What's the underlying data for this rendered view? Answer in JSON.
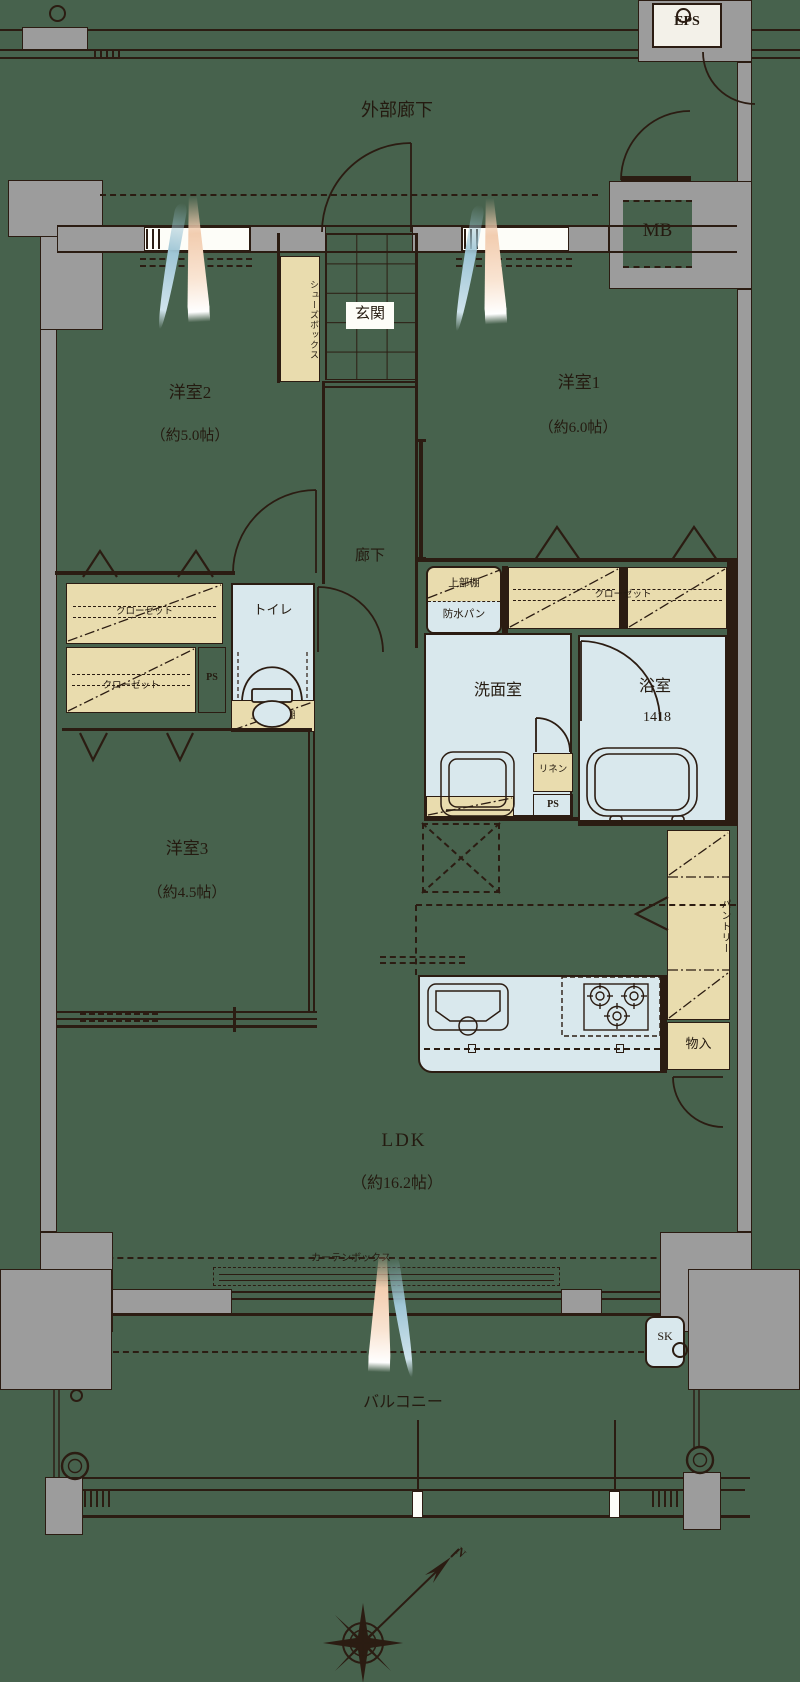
{
  "colors": {
    "background_green": "#47624d",
    "wall_gray": "#9c9c9c",
    "storage_beige": "#e9dcae",
    "water_blue": "#d9e8ed",
    "linework": "#2b1c12",
    "brush_pink": "#f2cdb0",
    "brush_blue": "#9fc6d6"
  },
  "exterior": {
    "outer_corridor": "外部廊下",
    "eps": "EPS",
    "mb": "MB",
    "balcony": "バルコニー",
    "sk": "SK",
    "curtain_box": "カーテンボックス",
    "compass_north": "N"
  },
  "rooms": {
    "bedroom1": {
      "name": "洋室1",
      "size": "（約6.0帖）"
    },
    "bedroom2": {
      "name": "洋室2",
      "size": "（約5.0帖）"
    },
    "bedroom3": {
      "name": "洋室3",
      "size": "（約4.5帖）"
    },
    "ldk": {
      "name": "LDK",
      "size": "（約16.2帖）"
    },
    "entrance": "玄関",
    "hallway": "廊下",
    "toilet": "トイレ",
    "washroom": "洗面室",
    "bathroom": {
      "name": "浴室",
      "size_code": "1418"
    }
  },
  "storage": {
    "shoes_box": "シューズボックス",
    "closet_bedroom2": "クローゼット",
    "closet_bedroom3": "クローゼット",
    "closet_bedroom1": "クローゼット",
    "pantry": "パントリー",
    "storage_closet": "物入",
    "linen": "リネン",
    "upper_shelf": "上部棚",
    "waterproof_pan": "防水パン",
    "upper_hanging_cupboard": "上部吊戸棚"
  },
  "service": {
    "ps_a": "PS",
    "ps_b": "PS"
  }
}
